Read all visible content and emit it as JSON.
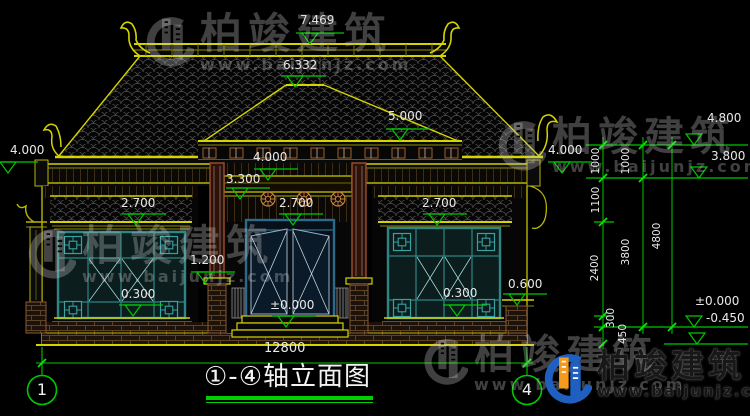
{
  "drawing": {
    "title": "①-④轴立面图",
    "axis_left": "1",
    "axis_right": "4",
    "total_width_mm": "12800"
  },
  "levels": {
    "ridge_top": "7.469",
    "porch_ridge": "6.332",
    "roof_mid": "5.000",
    "eave_left": "4.000",
    "porch_eave": "4.000",
    "eave_right": "4.000",
    "beam_top": "3.300",
    "wing_eave_left": "2.700",
    "door_head": "2.700",
    "wing_eave_right": "2.700",
    "pedestal_cap": "1.200",
    "sill_left": "0.300",
    "floor": "±0.000",
    "sill_right": "0.300",
    "side_wall_cap": "0.600",
    "right_parapet": "4.800",
    "right_upper": "3.800",
    "right_floor": "±0.000",
    "right_ground": "-0.450"
  },
  "chain_dims": {
    "seg_1000_a": "1000",
    "seg_1000_b": "1000",
    "seg_1100": "1100",
    "seg_2400": "2400",
    "seg_3800": "3800",
    "seg_4800": "4800",
    "seg_300": "300",
    "seg_450": "450"
  },
  "watermark": {
    "brand": "柏竣建筑",
    "url": "www.baijunjz.com"
  },
  "logo": {
    "brand": "柏竣建筑",
    "url": "www.baijunjz.com"
  },
  "colors": {
    "dim_green": "#00c800",
    "cad_yellow": "#b8b400",
    "cad_yellow_bright": "#d6d300",
    "window_teal": "#2e8585",
    "logo_blue": "#1f5fc0",
    "logo_orange": "#f59a1d"
  }
}
